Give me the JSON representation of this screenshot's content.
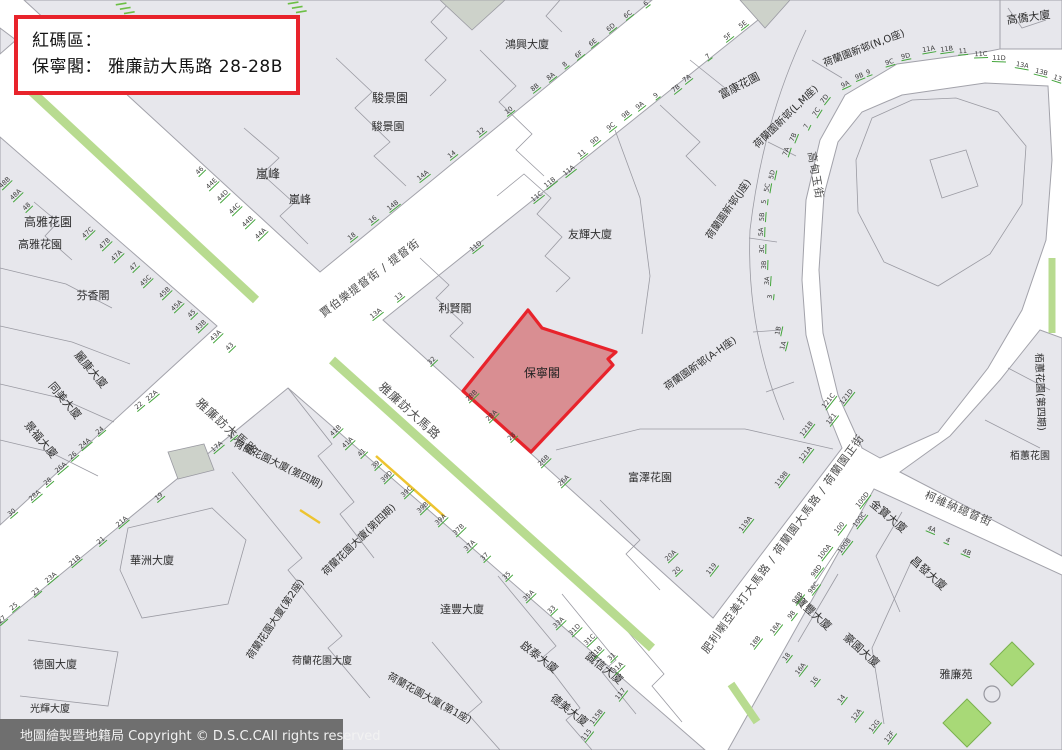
{
  "alert_box": {
    "line1": "紅碼區：",
    "line2": "保寧閣： 雅廉訪大馬路 28-28B"
  },
  "footer": {
    "text": "地圖繪製暨地籍局 Copyright © D.S.C.CAll rights reserved"
  },
  "red_zone": {
    "label": "保寧閣",
    "address": "雅廉訪大馬路 28-28B",
    "label_x": 542,
    "label_y": 377
  },
  "colors": {
    "block": "#e7e7ec",
    "street": "#ffffff",
    "outline": "#a2a2aa",
    "median_green": "#b8db90",
    "park_green": "#a8d977",
    "park_stroke": "#7ab24e",
    "number_green": "#43a53b",
    "zone_fill": "#d98e92",
    "zone_stroke": "#e8232b",
    "yellow_mark": "#edc431",
    "bar_bg": "#6f6f6f",
    "dark_building": "#cdd2ca"
  },
  "streets": [
    {
      "name": "雅廉訪大馬路",
      "x": 224,
      "y": 430,
      "rot": 42,
      "size": 12
    },
    {
      "name": "雅廉訪大馬路",
      "x": 407,
      "y": 414,
      "rot": 42,
      "size": 12
    },
    {
      "name": "賈伯樂提督街 / 提督街",
      "x": 372,
      "y": 281,
      "rot": -37,
      "size": 11
    },
    {
      "name": "肥利喇亞美打大馬路 / 荷蘭園大馬路 / 荷蘭園正街",
      "x": 786,
      "y": 546,
      "rot": -54,
      "size": 11
    },
    {
      "name": "柯維納總督街",
      "x": 957,
      "y": 512,
      "rot": 23,
      "size": 11
    },
    {
      "name": "高甸玉街",
      "x": 812,
      "y": 176,
      "rot": 80,
      "size": 11
    }
  ],
  "buildings": [
    {
      "name": "鴻興大廈",
      "x": 527,
      "y": 48,
      "rot": 0,
      "size": 11
    },
    {
      "name": "駿景園",
      "x": 390,
      "y": 102,
      "rot": 0,
      "size": 12
    },
    {
      "name": "駿景園",
      "x": 388,
      "y": 130,
      "rot": 0,
      "size": 11
    },
    {
      "name": "嵐峰",
      "x": 268,
      "y": 178,
      "rot": 0,
      "size": 12
    },
    {
      "name": "嵐峰",
      "x": 300,
      "y": 203,
      "rot": 0,
      "size": 11
    },
    {
      "name": "高雅花園",
      "x": 48,
      "y": 226,
      "rot": 0,
      "size": 12
    },
    {
      "name": "高雅花園",
      "x": 40,
      "y": 248,
      "rot": 0,
      "size": 11
    },
    {
      "name": "芬香閣",
      "x": 93,
      "y": 299,
      "rot": 0,
      "size": 11
    },
    {
      "name": "麗康大廈",
      "x": 88,
      "y": 372,
      "rot": 50,
      "size": 11
    },
    {
      "name": "同美大廈",
      "x": 62,
      "y": 403,
      "rot": 50,
      "size": 11
    },
    {
      "name": "景福大廈",
      "x": 38,
      "y": 442,
      "rot": 50,
      "size": 11
    },
    {
      "name": "華洲大廈",
      "x": 152,
      "y": 564,
      "rot": 0,
      "size": 11
    },
    {
      "name": "德園大廈",
      "x": 55,
      "y": 668,
      "rot": 0,
      "size": 11
    },
    {
      "name": "光輝大廈",
      "x": 50,
      "y": 712,
      "rot": 0,
      "size": 10
    },
    {
      "name": "利賢閣",
      "x": 455,
      "y": 312,
      "rot": 0,
      "size": 11
    },
    {
      "name": "友輝大廈",
      "x": 590,
      "y": 238,
      "rot": 0,
      "size": 11
    },
    {
      "name": "富澤花園",
      "x": 650,
      "y": 481,
      "rot": 0,
      "size": 11
    },
    {
      "name": "富康花園",
      "x": 741,
      "y": 89,
      "rot": -27,
      "size": 11
    },
    {
      "name": "高僑大廈",
      "x": 1029,
      "y": 21,
      "rot": -8,
      "size": 11
    },
    {
      "name": "荷蘭園新邨(N,O座)",
      "x": 865,
      "y": 51,
      "rot": -21,
      "size": 10
    },
    {
      "name": "荷蘭園新邨(L,M座)",
      "x": 788,
      "y": 119,
      "rot": -44,
      "size": 10
    },
    {
      "name": "荷蘭園新邨(J座)",
      "x": 731,
      "y": 211,
      "rot": -55,
      "size": 10
    },
    {
      "name": "荷蘭園新邨(A-H座)",
      "x": 702,
      "y": 366,
      "rot": -35,
      "size": 10
    },
    {
      "name": "荷蘭花園大廈(第四期)",
      "x": 277,
      "y": 467,
      "rot": 26,
      "size": 10
    },
    {
      "name": "荷蘭花園大廈(第四期)",
      "x": 361,
      "y": 542,
      "rot": -44,
      "size": 10
    },
    {
      "name": "荷蘭花園大廈(第2座)",
      "x": 278,
      "y": 621,
      "rot": -56,
      "size": 10
    },
    {
      "name": "荷蘭花園大廈(第1座)",
      "x": 428,
      "y": 701,
      "rot": 29,
      "size": 10
    },
    {
      "name": "荷蘭花園大廈",
      "x": 322,
      "y": 664,
      "rot": 0,
      "size": 10
    },
    {
      "name": "達豐大廈",
      "x": 462,
      "y": 613,
      "rot": 0,
      "size": 11
    },
    {
      "name": "啟泰大廈",
      "x": 537,
      "y": 660,
      "rot": 38,
      "size": 11
    },
    {
      "name": "誠信大廈",
      "x": 602,
      "y": 671,
      "rot": 38,
      "size": 11
    },
    {
      "name": "德美大廈",
      "x": 567,
      "y": 713,
      "rot": 38,
      "size": 11
    },
    {
      "name": "金寶大廈",
      "x": 886,
      "y": 519,
      "rot": 40,
      "size": 11
    },
    {
      "name": "昌發大廈",
      "x": 926,
      "y": 576,
      "rot": 42,
      "size": 11
    },
    {
      "name": "寶豐大廈",
      "x": 811,
      "y": 616,
      "rot": 42,
      "size": 11
    },
    {
      "name": "豪園大廈",
      "x": 859,
      "y": 653,
      "rot": 42,
      "size": 11
    },
    {
      "name": "雅廉苑",
      "x": 956,
      "y": 678,
      "rot": 0,
      "size": 11
    },
    {
      "name": "栢蕙花園(第四期)",
      "x": 1037,
      "y": 392,
      "rot": 88,
      "size": 10
    },
    {
      "name": "栢蕙花園",
      "x": 1030,
      "y": 459,
      "rot": 0,
      "size": 10
    }
  ],
  "house_numbers": [
    {
      "n": "46",
      "x": 201,
      "y": 172,
      "r": -44
    },
    {
      "n": "44E",
      "x": 213,
      "y": 185,
      "r": -44
    },
    {
      "n": "44D",
      "x": 224,
      "y": 197,
      "r": -44
    },
    {
      "n": "44C",
      "x": 236,
      "y": 210,
      "r": -44
    },
    {
      "n": "44B",
      "x": 249,
      "y": 223,
      "r": -44
    },
    {
      "n": "44A",
      "x": 262,
      "y": 235,
      "r": -44
    },
    {
      "n": "32",
      "x": 433,
      "y": 362,
      "r": -44
    },
    {
      "n": "28B",
      "x": 473,
      "y": 397,
      "r": -44
    },
    {
      "n": "28A",
      "x": 493,
      "y": 417,
      "r": -44
    },
    {
      "n": "28",
      "x": 513,
      "y": 438,
      "r": -44
    },
    {
      "n": "26B",
      "x": 545,
      "y": 462,
      "r": -44
    },
    {
      "n": "26A",
      "x": 565,
      "y": 482,
      "r": -44
    },
    {
      "n": "20A",
      "x": 672,
      "y": 557,
      "r": -44
    },
    {
      "n": "20",
      "x": 678,
      "y": 572,
      "r": -44
    },
    {
      "n": "48B",
      "x": 6,
      "y": 184,
      "r": -44
    },
    {
      "n": "48A",
      "x": 17,
      "y": 196,
      "r": -44
    },
    {
      "n": "48",
      "x": 28,
      "y": 208,
      "r": -44
    },
    {
      "n": "47C",
      "x": 89,
      "y": 234,
      "r": -44
    },
    {
      "n": "47B",
      "x": 106,
      "y": 245,
      "r": -44
    },
    {
      "n": "47A",
      "x": 118,
      "y": 257,
      "r": -44
    },
    {
      "n": "47",
      "x": 135,
      "y": 268,
      "r": -44
    },
    {
      "n": "45C",
      "x": 147,
      "y": 282,
      "r": -44
    },
    {
      "n": "45B",
      "x": 166,
      "y": 294,
      "r": -44
    },
    {
      "n": "45A",
      "x": 178,
      "y": 307,
      "r": -44
    },
    {
      "n": "45",
      "x": 193,
      "y": 315,
      "r": -44
    },
    {
      "n": "43B",
      "x": 202,
      "y": 327,
      "r": -44
    },
    {
      "n": "43A",
      "x": 217,
      "y": 337,
      "r": -44
    },
    {
      "n": "43",
      "x": 231,
      "y": 348,
      "r": -44
    },
    {
      "n": "41B",
      "x": 337,
      "y": 432,
      "r": -44
    },
    {
      "n": "41A",
      "x": 349,
      "y": 444,
      "r": -44
    },
    {
      "n": "41",
      "x": 363,
      "y": 454,
      "r": -44
    },
    {
      "n": "39",
      "x": 377,
      "y": 466,
      "r": -44
    },
    {
      "n": "39D",
      "x": 388,
      "y": 478,
      "r": -44
    },
    {
      "n": "39C",
      "x": 408,
      "y": 493,
      "r": -44
    },
    {
      "n": "39B",
      "x": 424,
      "y": 509,
      "r": -44
    },
    {
      "n": "39A",
      "x": 442,
      "y": 521,
      "r": -44
    },
    {
      "n": "37B",
      "x": 460,
      "y": 531,
      "r": -44
    },
    {
      "n": "37A",
      "x": 471,
      "y": 547,
      "r": -44
    },
    {
      "n": "37",
      "x": 486,
      "y": 558,
      "r": -44
    },
    {
      "n": "35",
      "x": 508,
      "y": 577,
      "r": -44
    },
    {
      "n": "35A",
      "x": 530,
      "y": 597,
      "r": -44
    },
    {
      "n": "33",
      "x": 553,
      "y": 611,
      "r": -44
    },
    {
      "n": "33A",
      "x": 560,
      "y": 624,
      "r": -44
    },
    {
      "n": "31D",
      "x": 576,
      "y": 631,
      "r": -44
    },
    {
      "n": "31C",
      "x": 591,
      "y": 641,
      "r": -44
    },
    {
      "n": "31B",
      "x": 598,
      "y": 653,
      "r": -44
    },
    {
      "n": "31",
      "x": 613,
      "y": 658,
      "r": -44
    },
    {
      "n": "31A",
      "x": 619,
      "y": 669,
      "r": -44
    },
    {
      "n": "8B",
      "x": 536,
      "y": 89,
      "r": -38
    },
    {
      "n": "8A",
      "x": 552,
      "y": 78,
      "r": -38
    },
    {
      "n": "8",
      "x": 566,
      "y": 66,
      "r": -38
    },
    {
      "n": "6F",
      "x": 580,
      "y": 56,
      "r": -38
    },
    {
      "n": "6E",
      "x": 594,
      "y": 44,
      "r": -38
    },
    {
      "n": "6D",
      "x": 612,
      "y": 29,
      "r": -38
    },
    {
      "n": "6C",
      "x": 629,
      "y": 16,
      "r": -38
    },
    {
      "n": "6",
      "x": 647,
      "y": 5,
      "r": -38
    },
    {
      "n": "10",
      "x": 510,
      "y": 112,
      "r": -38
    },
    {
      "n": "12",
      "x": 482,
      "y": 133,
      "r": -38
    },
    {
      "n": "14",
      "x": 453,
      "y": 156,
      "r": -38
    },
    {
      "n": "14A",
      "x": 424,
      "y": 177,
      "r": -38
    },
    {
      "n": "14B",
      "x": 394,
      "y": 207,
      "r": -38
    },
    {
      "n": "16",
      "x": 374,
      "y": 221,
      "r": -38
    },
    {
      "n": "18",
      "x": 353,
      "y": 238,
      "r": -38
    },
    {
      "n": "5E",
      "x": 744,
      "y": 26,
      "r": -38
    },
    {
      "n": "5F",
      "x": 729,
      "y": 38,
      "r": -38
    },
    {
      "n": "7",
      "x": 709,
      "y": 58,
      "r": -38
    },
    {
      "n": "7A",
      "x": 688,
      "y": 80,
      "r": -38
    },
    {
      "n": "7B",
      "x": 677,
      "y": 90,
      "r": -38
    },
    {
      "n": "9",
      "x": 657,
      "y": 97,
      "r": -38
    },
    {
      "n": "9A",
      "x": 641,
      "y": 107,
      "r": -38
    },
    {
      "n": "9B",
      "x": 627,
      "y": 116,
      "r": -38
    },
    {
      "n": "9C",
      "x": 612,
      "y": 128,
      "r": -38
    },
    {
      "n": "9D",
      "x": 596,
      "y": 142,
      "r": -38
    },
    {
      "n": "11",
      "x": 583,
      "y": 155,
      "r": -38
    },
    {
      "n": "11A",
      "x": 570,
      "y": 172,
      "r": -38
    },
    {
      "n": "11B",
      "x": 551,
      "y": 184,
      "r": -38
    },
    {
      "n": "11C",
      "x": 538,
      "y": 198,
      "r": -38
    },
    {
      "n": "11D",
      "x": 477,
      "y": 248,
      "r": -38
    },
    {
      "n": "13",
      "x": 400,
      "y": 298,
      "r": -38
    },
    {
      "n": "13A",
      "x": 377,
      "y": 315,
      "r": -38
    },
    {
      "n": "22A",
      "x": 153,
      "y": 397,
      "r": -40
    },
    {
      "n": "22",
      "x": 140,
      "y": 407,
      "r": -40
    },
    {
      "n": "24",
      "x": 101,
      "y": 432,
      "r": -40
    },
    {
      "n": "24A",
      "x": 86,
      "y": 445,
      "r": -40
    },
    {
      "n": "26",
      "x": 74,
      "y": 457,
      "r": -40
    },
    {
      "n": "26A",
      "x": 62,
      "y": 469,
      "r": -40
    },
    {
      "n": "28",
      "x": 49,
      "y": 483,
      "r": -40
    },
    {
      "n": "28A",
      "x": 36,
      "y": 497,
      "r": -40
    },
    {
      "n": "30",
      "x": 13,
      "y": 514,
      "r": -40
    },
    {
      "n": "17",
      "x": 233,
      "y": 437,
      "r": -40
    },
    {
      "n": "17A",
      "x": 218,
      "y": 448,
      "r": -40
    },
    {
      "n": "19",
      "x": 160,
      "y": 498,
      "r": -40
    },
    {
      "n": "21A",
      "x": 123,
      "y": 523,
      "r": -40
    },
    {
      "n": "21",
      "x": 102,
      "y": 542,
      "r": -40
    },
    {
      "n": "21B",
      "x": 76,
      "y": 562,
      "r": -40
    },
    {
      "n": "23A",
      "x": 52,
      "y": 579,
      "r": -40
    },
    {
      "n": "23",
      "x": 37,
      "y": 593,
      "r": -40
    },
    {
      "n": "25",
      "x": 15,
      "y": 608,
      "r": -40
    },
    {
      "n": "27",
      "x": 3,
      "y": 621,
      "r": -40
    },
    {
      "n": "121D",
      "x": 848,
      "y": 398,
      "r": -52
    },
    {
      "n": "121C",
      "x": 830,
      "y": 402,
      "r": -52
    },
    {
      "n": "121",
      "x": 833,
      "y": 420,
      "r": -52
    },
    {
      "n": "121B",
      "x": 808,
      "y": 430,
      "r": -52
    },
    {
      "n": "121A",
      "x": 807,
      "y": 455,
      "r": -52
    },
    {
      "n": "119B",
      "x": 783,
      "y": 480,
      "r": -52
    },
    {
      "n": "119A",
      "x": 747,
      "y": 525,
      "r": -52
    },
    {
      "n": "119",
      "x": 713,
      "y": 570,
      "r": -52
    },
    {
      "n": "100D",
      "x": 864,
      "y": 501,
      "r": -52
    },
    {
      "n": "100C",
      "x": 861,
      "y": 521,
      "r": -52
    },
    {
      "n": "100",
      "x": 841,
      "y": 529,
      "r": -52
    },
    {
      "n": "100B",
      "x": 846,
      "y": 547,
      "r": -52
    },
    {
      "n": "100A",
      "x": 826,
      "y": 553,
      "r": -52
    },
    {
      "n": "98D",
      "x": 818,
      "y": 572,
      "r": -52
    },
    {
      "n": "98C",
      "x": 815,
      "y": 589,
      "r": -52
    },
    {
      "n": "98B",
      "x": 799,
      "y": 599,
      "r": -52
    },
    {
      "n": "98",
      "x": 793,
      "y": 616,
      "r": -52
    },
    {
      "n": "18A",
      "x": 777,
      "y": 629,
      "r": -52
    },
    {
      "n": "18B",
      "x": 757,
      "y": 643,
      "r": -52
    },
    {
      "n": "18",
      "x": 788,
      "y": 658,
      "r": -52
    },
    {
      "n": "16A",
      "x": 802,
      "y": 670,
      "r": -52
    },
    {
      "n": "16",
      "x": 816,
      "y": 682,
      "r": -52
    },
    {
      "n": "14",
      "x": 843,
      "y": 700,
      "r": -52
    },
    {
      "n": "12A",
      "x": 858,
      "y": 716,
      "r": -52
    },
    {
      "n": "12G",
      "x": 876,
      "y": 727,
      "r": -52
    },
    {
      "n": "12F",
      "x": 891,
      "y": 738,
      "r": -52
    },
    {
      "n": "4A",
      "x": 931,
      "y": 531,
      "r": 23
    },
    {
      "n": "4",
      "x": 947,
      "y": 542,
      "r": 23
    },
    {
      "n": "4B",
      "x": 966,
      "y": 554,
      "r": 23
    },
    {
      "n": "117",
      "x": 622,
      "y": 695,
      "r": -52
    },
    {
      "n": "115B",
      "x": 598,
      "y": 718,
      "r": -52
    },
    {
      "n": "115",
      "x": 588,
      "y": 736,
      "r": -52
    },
    {
      "n": "9A",
      "x": 846,
      "y": 86,
      "r": -25
    },
    {
      "n": "9B",
      "x": 860,
      "y": 78,
      "r": -22
    },
    {
      "n": "9",
      "x": 869,
      "y": 74,
      "r": -20
    },
    {
      "n": "9C",
      "x": 890,
      "y": 64,
      "r": -16
    },
    {
      "n": "9D",
      "x": 906,
      "y": 58,
      "r": -12
    },
    {
      "n": "11A",
      "x": 929,
      "y": 51,
      "r": -10
    },
    {
      "n": "11B",
      "x": 947,
      "y": 51,
      "r": -8
    },
    {
      "n": "11",
      "x": 963,
      "y": 53,
      "r": -5
    },
    {
      "n": "11C",
      "x": 981,
      "y": 56,
      "r": -2
    },
    {
      "n": "11D",
      "x": 999,
      "y": 60,
      "r": 2
    },
    {
      "n": "13A",
      "x": 1022,
      "y": 67,
      "r": 10
    },
    {
      "n": "13B",
      "x": 1041,
      "y": 74,
      "r": 14
    },
    {
      "n": "13",
      "x": 1057,
      "y": 80,
      "r": 18
    },
    {
      "n": "7D",
      "x": 826,
      "y": 100,
      "r": -52
    },
    {
      "n": "7C",
      "x": 818,
      "y": 113,
      "r": -58
    },
    {
      "n": "7",
      "x": 808,
      "y": 127,
      "r": -64
    },
    {
      "n": "7B",
      "x": 795,
      "y": 138,
      "r": -68
    },
    {
      "n": "7A",
      "x": 788,
      "y": 152,
      "r": -72
    },
    {
      "n": "5D",
      "x": 774,
      "y": 175,
      "r": -78
    },
    {
      "n": "5C",
      "x": 769,
      "y": 188,
      "r": -80
    },
    {
      "n": "5",
      "x": 766,
      "y": 202,
      "r": -84
    },
    {
      "n": "5B",
      "x": 764,
      "y": 217,
      "r": -86
    },
    {
      "n": "5A",
      "x": 763,
      "y": 232,
      "r": -88
    },
    {
      "n": "3C",
      "x": 764,
      "y": 249,
      "r": -89
    },
    {
      "n": "3B",
      "x": 766,
      "y": 265,
      "r": -88
    },
    {
      "n": "3A",
      "x": 769,
      "y": 281,
      "r": -86
    },
    {
      "n": "3",
      "x": 772,
      "y": 297,
      "r": -84
    },
    {
      "n": "1B",
      "x": 780,
      "y": 331,
      "r": -78
    },
    {
      "n": "1A",
      "x": 785,
      "y": 346,
      "r": -75
    }
  ]
}
